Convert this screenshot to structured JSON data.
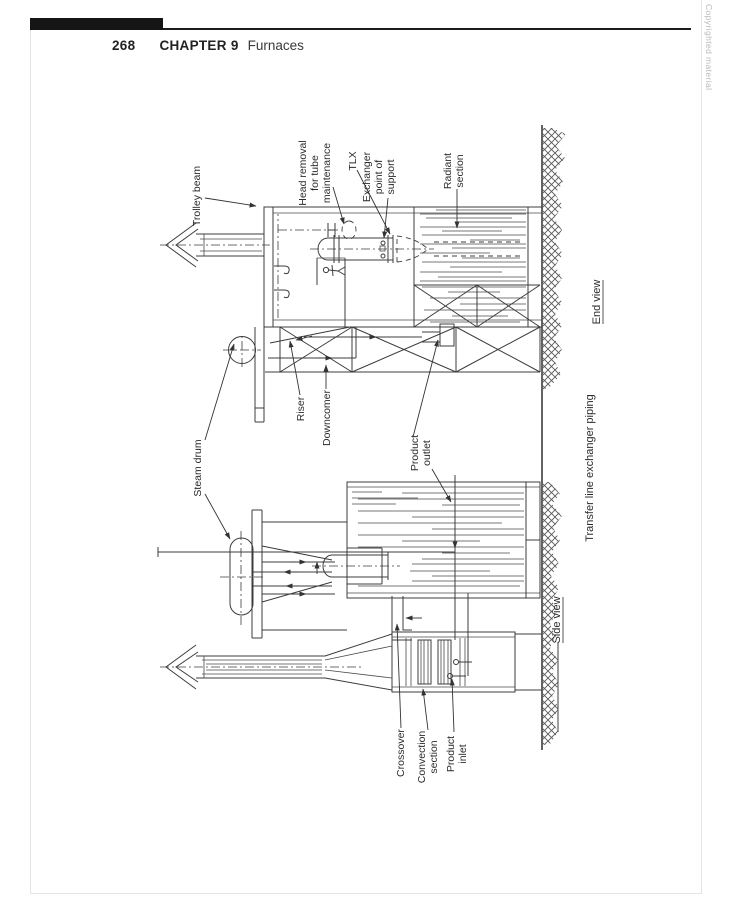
{
  "header": {
    "page_number": "268",
    "chapter_label": "CHAPTER 9",
    "chapter_title": "Furnaces",
    "copyright": "Copyrighted material"
  },
  "figure": {
    "caption": "Transfer line exchanger piping",
    "end_view_label": "End view",
    "side_view_label": "Side view",
    "labels": {
      "trolley_beam": "Trolley beam",
      "head_removal": [
        "Head removal",
        "for tube",
        "maintenance"
      ],
      "tlx": "TLX",
      "exchanger_support": [
        "Exchanger",
        "point of",
        "support"
      ],
      "radiant_section": [
        "Radiant",
        "section"
      ],
      "steam_drum": "Steam drum",
      "riser": "Riser",
      "downcomer": "Downcomer",
      "product_outlet": [
        "Product",
        "outlet"
      ],
      "crossover": "Crossover",
      "convection_section": [
        "Convection",
        "section"
      ],
      "product_inlet": [
        "Product",
        "inlet"
      ]
    }
  }
}
